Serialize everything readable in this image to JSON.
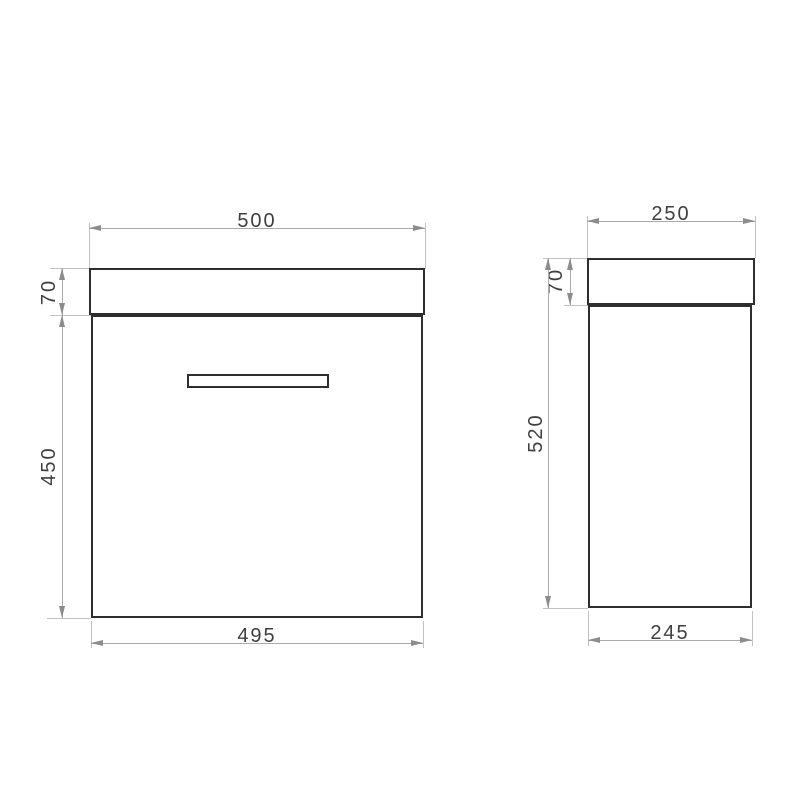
{
  "drawing": {
    "front_view": {
      "top_width": "500",
      "countertop_height": "70",
      "body_height": "450",
      "bottom_width": "495"
    },
    "side_view": {
      "top_depth": "250",
      "countertop_height": "70",
      "total_height": "520",
      "bottom_depth": "245"
    }
  },
  "colors": {
    "background": "#ffffff",
    "outline": "#2e2e2e",
    "dimension_line": "#a9a9a9",
    "extension_line": "#c2c2c2",
    "arrow": "#8c8c8c",
    "dimension_text": "#3f3f3f"
  }
}
